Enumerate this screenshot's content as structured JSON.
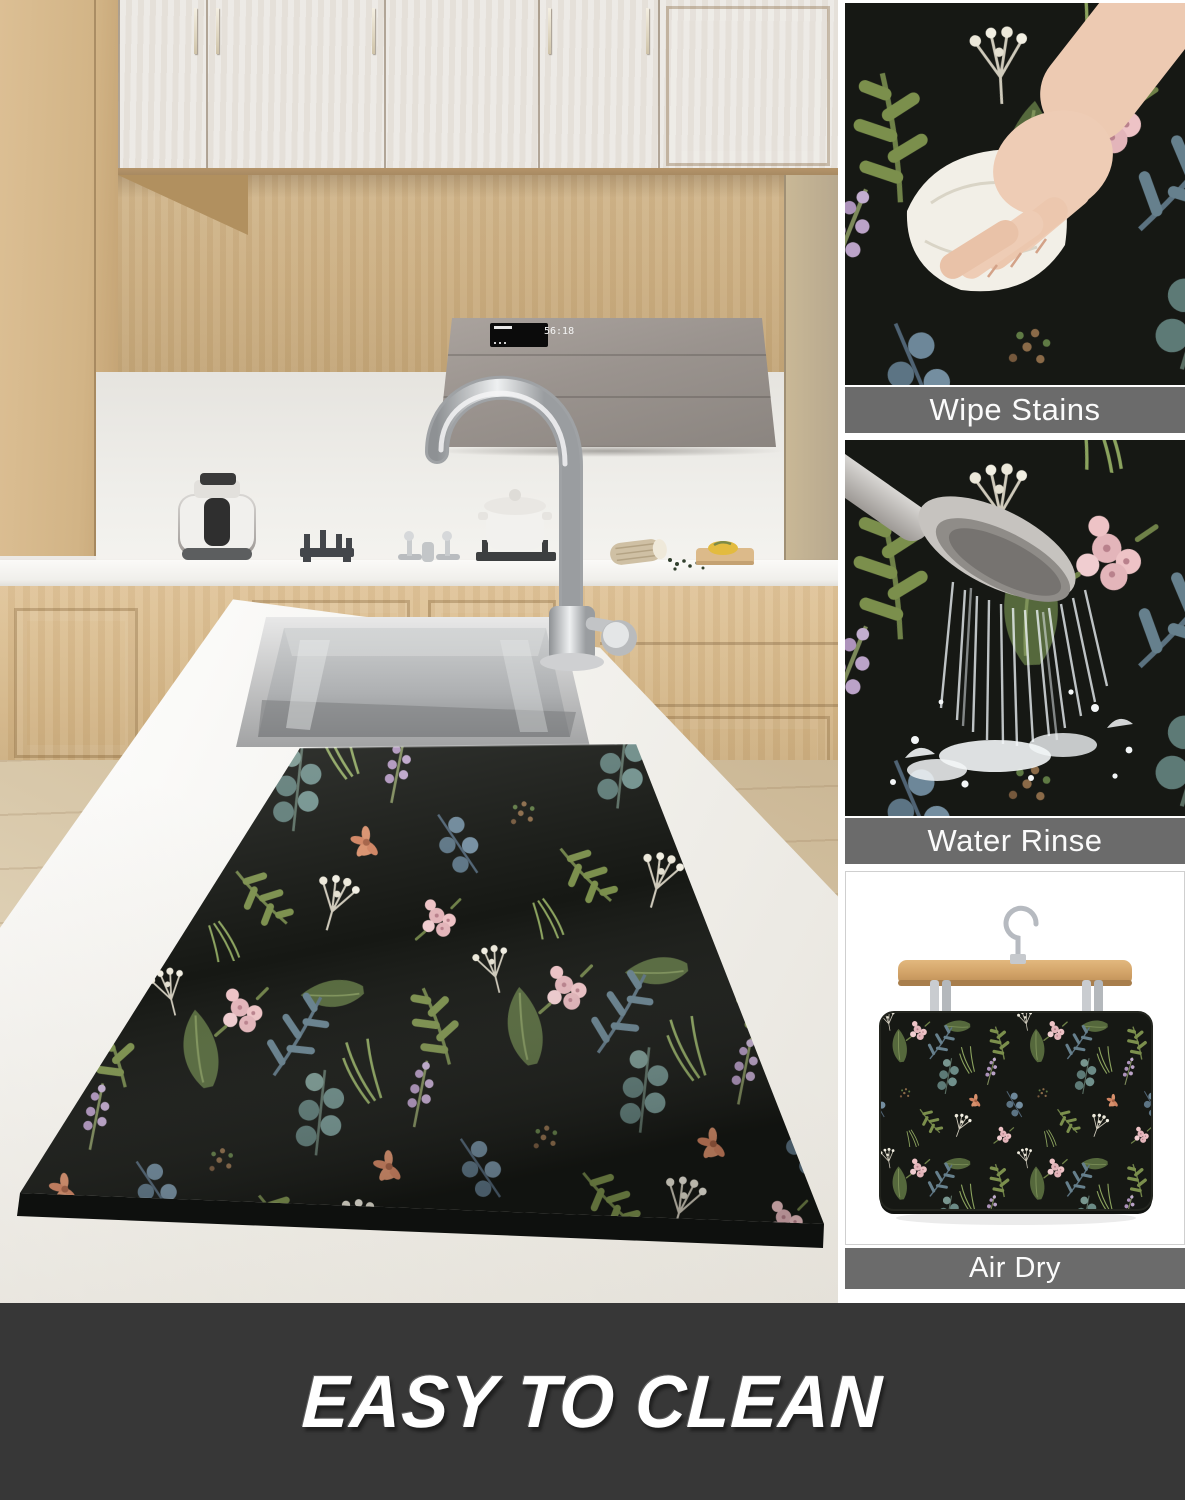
{
  "poster": {
    "type": "product-feature-image",
    "banner": {
      "text": "EASY TO CLEAN"
    },
    "features": [
      {
        "label": "Wipe Stains",
        "icon": "hand-wiping-cloth-icon"
      },
      {
        "label": "Water Rinse",
        "icon": "shower-head-icon"
      },
      {
        "label": "Air Dry",
        "icon": "clothes-hanger-icon"
      }
    ],
    "kitchen": {
      "hood_display": "56:18"
    },
    "colors": {
      "banner_bg": "#373737",
      "banner_text": "#ffffff",
      "label_bg": "#6b6b6b",
      "label_text": "#fbfbfb",
      "mat_bg": "#161814",
      "leaf_green": "#75874b",
      "leaf_dark": "#4a5f38",
      "blossom_pink": "#e7bcc0",
      "blossom_white": "#efece0",
      "eucalyptus_teal": "#5d7a76",
      "fern_blue": "#66808d",
      "lavender": "#b197bd",
      "coral": "#d8906c",
      "wood_light": "#dcc097",
      "counter_white": "#f4f3ef"
    }
  }
}
